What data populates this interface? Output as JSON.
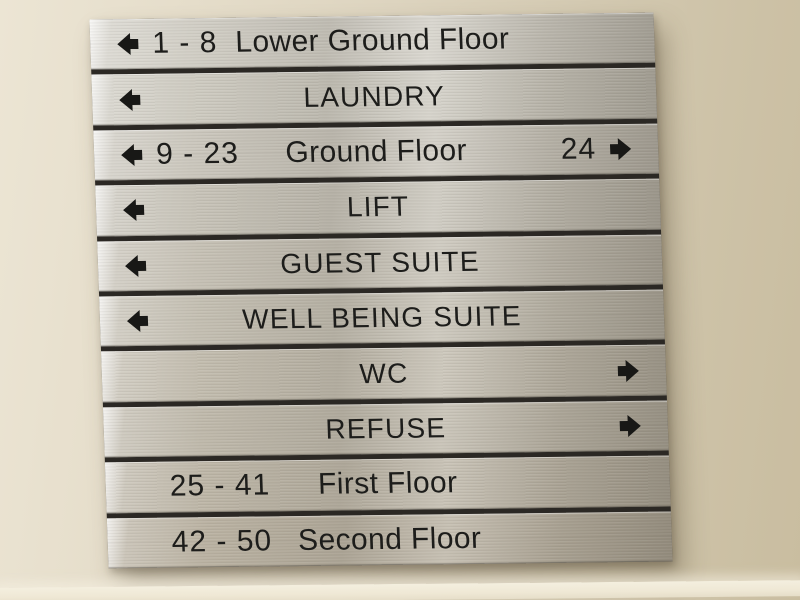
{
  "palette": {
    "wall_left": "#ece5d4",
    "wall_right": "#c9bda0",
    "plate_silver": "#c9c5bb",
    "plate_gap_dark": "#2b2824",
    "text_black": "#1d1d1b",
    "baseboard_light": "#f1ebd9"
  },
  "sign": {
    "rows": [
      {
        "arrow_left": true,
        "arrow_right": false,
        "range": "1 - 8",
        "label": "Lower Ground Floor"
      },
      {
        "arrow_left": true,
        "arrow_right": false,
        "label": "LAUNDRY"
      },
      {
        "arrow_left": true,
        "arrow_right": true,
        "range": "9 - 23",
        "label": "Ground Floor",
        "right_value": "24"
      },
      {
        "arrow_left": true,
        "arrow_right": false,
        "label": "LIFT"
      },
      {
        "arrow_left": true,
        "arrow_right": false,
        "label": "GUEST SUITE"
      },
      {
        "arrow_left": true,
        "arrow_right": false,
        "label": "WELL BEING SUITE"
      },
      {
        "arrow_left": false,
        "arrow_right": true,
        "label": "WC"
      },
      {
        "arrow_left": false,
        "arrow_right": true,
        "label": "REFUSE"
      },
      {
        "arrow_left": false,
        "arrow_right": false,
        "range": "25 - 41",
        "label": "First Floor"
      },
      {
        "arrow_left": false,
        "arrow_right": false,
        "range": "42 - 50",
        "label": "Second Floor"
      }
    ]
  }
}
